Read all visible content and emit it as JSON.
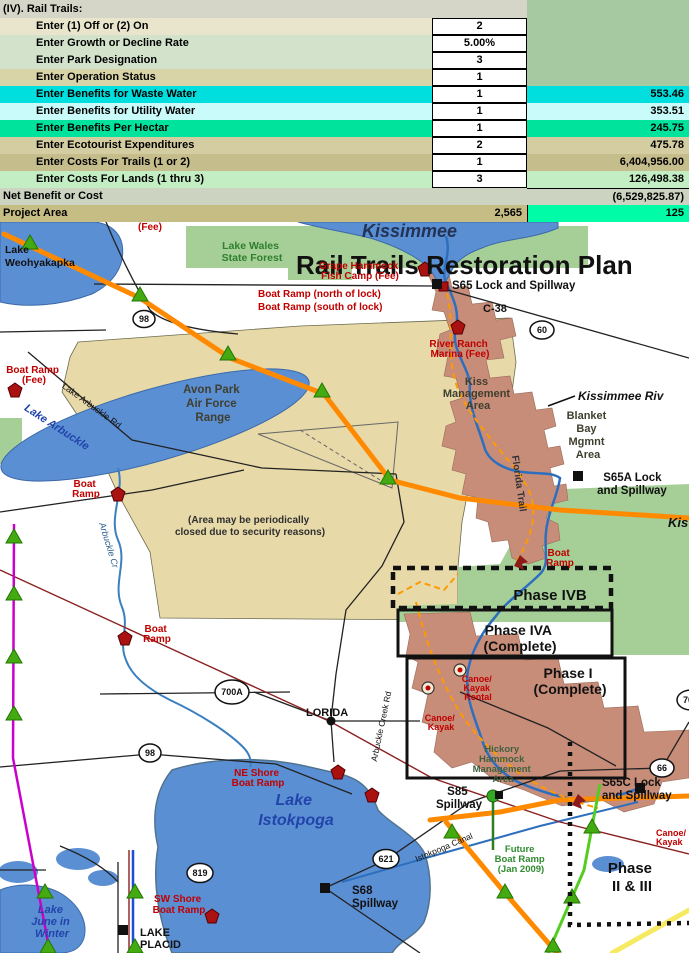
{
  "sheet": {
    "section_label": "(IV).  Rail Trails:",
    "rows": [
      {
        "label": "Enter (1) Off  or (2) On",
        "input": "2",
        "value": ""
      },
      {
        "label": "Enter Growth or Decline Rate",
        "input": "5.00%",
        "value": ""
      },
      {
        "label": "Enter Park Designation",
        "input": "3",
        "value": ""
      },
      {
        "label": "Enter Operation Status",
        "input": "1",
        "value": ""
      },
      {
        "label": "Enter Benefits for Waste Water",
        "input": "1",
        "value": "553.46"
      },
      {
        "label": "Enter Benefits for Utility Water",
        "input": "1",
        "value": "353.51"
      },
      {
        "label": "Enter Benefits Per Hectar",
        "input": "1",
        "value": "245.75"
      },
      {
        "label": "Enter Ecotourist Expenditures",
        "input": "2",
        "value": "475.78"
      },
      {
        "label": "Enter Costs For Trails (1 or 2)",
        "input": "1",
        "value": "6,404,956.00"
      },
      {
        "label": "Enter Costs For Lands  (1 thru 3)",
        "input": "3",
        "value": "126,498.38"
      }
    ],
    "net_row": {
      "label": "Net Benefit or Cost",
      "value": "(6,529,825.87)"
    },
    "area_row": {
      "label": "Project Area",
      "input": "2,565",
      "value": "125"
    }
  },
  "map": {
    "title": "Rail Trails Restoration Plan",
    "colors": {
      "water": "#5b8fd4",
      "forest_green": "#a5cf97",
      "range_tan": "#e8d9a8",
      "corridor_salmon": "#c78d79",
      "orange_road": "#ff8a00",
      "trail_magenta": "#cc00cc",
      "trail_green": "#55cc22",
      "yellow_road": "#f5ea62"
    },
    "labels": {
      "lake_kissimmee": "Kissimmee",
      "lake_weohyakapka": [
        "Lake",
        "Weohyakapka"
      ],
      "fee_top": "(Fee)",
      "lake_wales": [
        "Lake Wales",
        "State Forest"
      ],
      "grape_hammock": [
        "Grape Hammock",
        "Fish Camp (Fee)"
      ],
      "s65_lock": "S65 Lock and Spillway",
      "boat_ramp_north": "Boat Ramp (north of lock)",
      "boat_ramp_south": "Boat Ramp (south of lock)",
      "c38": "C-38",
      "hwy60": "60",
      "hwy98_n": "98",
      "hwy98_s": "98",
      "hwy700a": "700A",
      "hwy66": "66",
      "hwy621": "621",
      "hwy819": "819",
      "hwy70": "70",
      "river_ranch": [
        "River Ranch",
        "Marina (Fee)"
      ],
      "kiss_mgmt": [
        "Kiss",
        "Management",
        "Area"
      ],
      "kissimmee_riv": "Kissimmee Riv",
      "blanket_bay": [
        "Blanket",
        "Bay",
        "Mgmnt",
        "Area"
      ],
      "s65a_lock": [
        "S65A Lock",
        "and Spillway"
      ],
      "kis_edge": "Kis",
      "avon_park": [
        "Avon Park",
        "Air Force",
        "Range"
      ],
      "area_note": [
        "(Area may be periodically",
        "closed due to security reasons)"
      ],
      "lake_arbuckle_rd": "Lake Arbuckle Rd",
      "lake_arbuckle": "Lake Arbuckle",
      "boat_ramp_fee": [
        "Boat Ramp",
        "(Fee)"
      ],
      "boat_ramp_creek": [
        "Boat",
        "Ramp"
      ],
      "arbuckle_creek": "Arbuckle Cr",
      "boat_ramp_mid": [
        "Boat",
        "Ramp"
      ],
      "lorida": "LORIDA",
      "creek_rd": "Arbuckle Creek Rd",
      "boat_ramp_ivb": [
        "Boat",
        "Ramp"
      ],
      "phase_ivb": "Phase IVB",
      "phase_iva": [
        "Phase IVA",
        "(Complete)"
      ],
      "phase_i": [
        "Phase I",
        "(Complete)"
      ],
      "canoe_rental": [
        "Canoe/",
        "Kayak",
        "Rental"
      ],
      "canoe_kayak": [
        "Canoe/",
        "Kayak"
      ],
      "hickory": [
        "Hickory",
        "Hammock",
        "Management",
        "Area"
      ],
      "s65c_lock": [
        "S65C Lock",
        "and Spillway"
      ],
      "canoe_kayak_e": [
        "Canoe/",
        "Kayak"
      ],
      "s85": [
        "S85",
        "Spillway"
      ],
      "future_ramp": [
        "Future",
        "Boat Ramp",
        "(Jan 2009)"
      ],
      "phase_2_3": [
        "Phase",
        "II & III"
      ],
      "ne_shore": [
        "NE Shore",
        "Boat Ramp"
      ],
      "lake_istokpoga": [
        "Lake",
        "Istokpoga"
      ],
      "istokpoga_canal": "Istokpoga Canal",
      "sw_shore": [
        "SW Shore",
        "Boat Ramp"
      ],
      "s68": [
        "S68",
        "Spillway"
      ],
      "lake_june": [
        "Lake",
        "June in",
        "Winter"
      ],
      "lake_placid": [
        "LAKE",
        "PLACID"
      ],
      "florida_trail": "Florida Trail"
    }
  }
}
